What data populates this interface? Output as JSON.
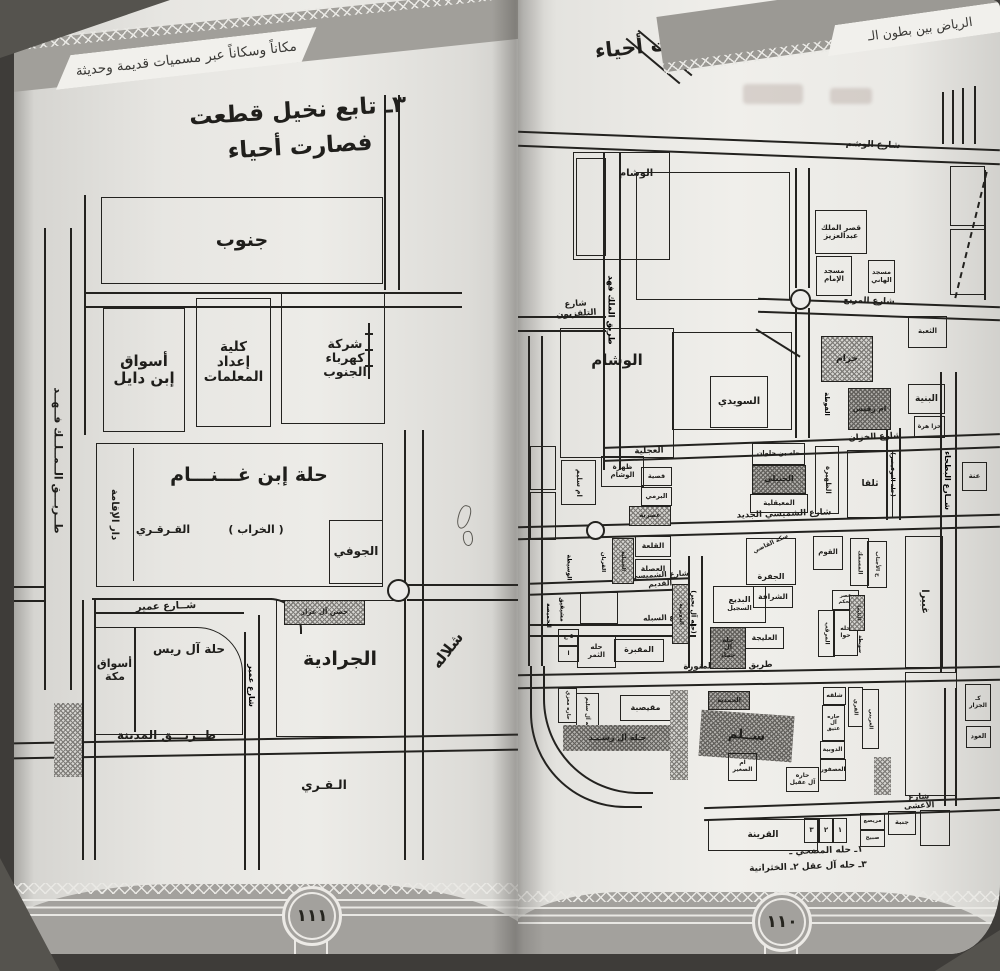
{
  "left_page": {
    "running_head": "مكاناً وسكاناً عبر مسميات قديمة وحديثة",
    "title_line1": "٣ـ تابع نخيل قطعت",
    "title_line2": "فصارت أحياء",
    "page_number": "١١١",
    "labels": {
      "janub": "جنوب",
      "aswaq_ibn_dayil": "أسواق\nإبن دايل",
      "kulliya": "كلية\nإعداد\nالمعلمات",
      "sharika": "شركة\nكهرباء\nالجنوب",
      "ibn_ghannam": "حلة إبن غـــنـــام",
      "qarqari": "القـرقـري",
      "kharab": "( الخراب )",
      "jawfi": "الجوفي",
      "dar_iqama": "دار الإقامة",
      "malik_fahd": "طــريـــق الــمــلــك فــهــد",
      "hisn": "حصن آل عرار",
      "share_umair": "شــارع عمير",
      "share_umair_v": "شارع عمير",
      "al_rais": "حلة آل ريس",
      "aswaq_makkah": "أسواق\nمكة",
      "jaradiya": "الجرادية",
      "shallala": "شلاله",
      "tariq_madina": "طــريـــق المدينة",
      "qari": "الـقـري"
    }
  },
  "right_page": {
    "running_head": "الرياض بين بطون الـ",
    "title": "٣ـ نخيل ومزارع قطعت فصارت أحياء",
    "page_number": "١١٠",
    "captions": {
      "c1": "١ـ حله المضحي ـ",
      "c2": "٣ـ حله آل عقل   ٢ـ الخثرانية"
    },
    "labels": {
      "share_washm": "شارع الوشم",
      "wusham_top": "الوشام",
      "malik_fahd": "طريق الملك فهد",
      "qasr_malik": "قصر الملك\nعبدالعزيز",
      "masjid_imam": "مسجد\nالإمام",
      "masjid_hani": "مسجد\nالهاني",
      "share_tv": "شارع التلفزيون",
      "share_murabba": "شارع المربع",
      "wusham_big": "الوشام",
      "suwaidi": "السويدي",
      "khuzam": "خزام",
      "um_ruqays": "ام رقيس",
      "futa": "الفوطة",
      "thaaba": "الثعبة",
      "binya": "البنية",
      "khaza_hara": "خزا هرة",
      "anna": "عنة",
      "share_khazzan": "شارع الخزان",
      "ajliya": "العجلية",
      "zahrat_wusham": "ظهرة\nالوشام",
      "um_salim": "ام سليم",
      "qasiya": "قصية",
      "barami": "البرمي",
      "asriya": "عصرية",
      "bin_halwan": "حله بن حلوان",
      "hanbali": "الحنبلي",
      "muayqiliya": "المعيقلية",
      "zahira": "الظهيرة",
      "thalqa": "ثلقا",
      "nawfaysir": "(حلة النوفيصر)",
      "bathaa": "شــارع البطحاء",
      "qalaa": "القلعة",
      "asla": "العصلة",
      "hanbaliya": "الحنبلية",
      "qurban": "القربان",
      "wasita": "الوسيطة",
      "shumaysi_jadid": "شارع الشميسي الجديد",
      "shumaysi_qadim": "شارع الشميسي القديم",
      "sikkat_qadi": "سكة القاضي",
      "jafra": "الجفرة",
      "qawm": "القوم",
      "masmak": "المسمك",
      "h_ajnab": "ح الأجناب",
      "ghubayra": "غبيرا",
      "mushayqiq": "مشيقيق",
      "humaysa": "الحميصة",
      "badi": "البديع",
      "sajil": "السجيل",
      "duwayriya": "الدويرية",
      "al_buhayr": "(حله آل بحير)",
      "sharafa": "الشرافة",
      "qasr_hukm": "قصر الحكم",
      "marqab": "المرقب",
      "hillat_hawa": "حله\nحوا",
      "thulayma": "الثليما",
      "suwayta": "سويطة",
      "aleeja": "العليجة",
      "al_hamad": "حله\nآل\nحماد",
      "share_sabla": "شارع السبله",
      "tiny1": "٥ ع",
      "tiny2": "ا",
      "thamar": "حله\nالثمر",
      "maqbara": "المقبرة",
      "hara_mazi": "حاره معزي",
      "al_salim": "حله آل سليم",
      "muqaysaba": "مقيصبة",
      "al_rashid": "حـله آل رشـيـد",
      "madina_road": "طريق المدينة المنورة",
      "hamdiya": "الحمدية",
      "salam": "ســلم",
      "um_saghir": "ام\nالصغير",
      "al_aqil": "حاره\nآل عقيل",
      "shalqa": "شلقه",
      "al_atiq": "حاره\nآل عتيق",
      "dubiya": "الدوبية",
      "usfur": "العصفور",
      "qari": "القري",
      "urayni": "العريني",
      "jazzar": "كـ\nالجزار",
      "oud": "العود",
      "share_asha": "شارع الأعشى",
      "n1": "١",
      "n2": "٢",
      "n3": "٣",
      "muraysi": "مريصع",
      "sabih": "صبيح",
      "janba": "جنبة",
      "qarina": "القرينة"
    }
  }
}
